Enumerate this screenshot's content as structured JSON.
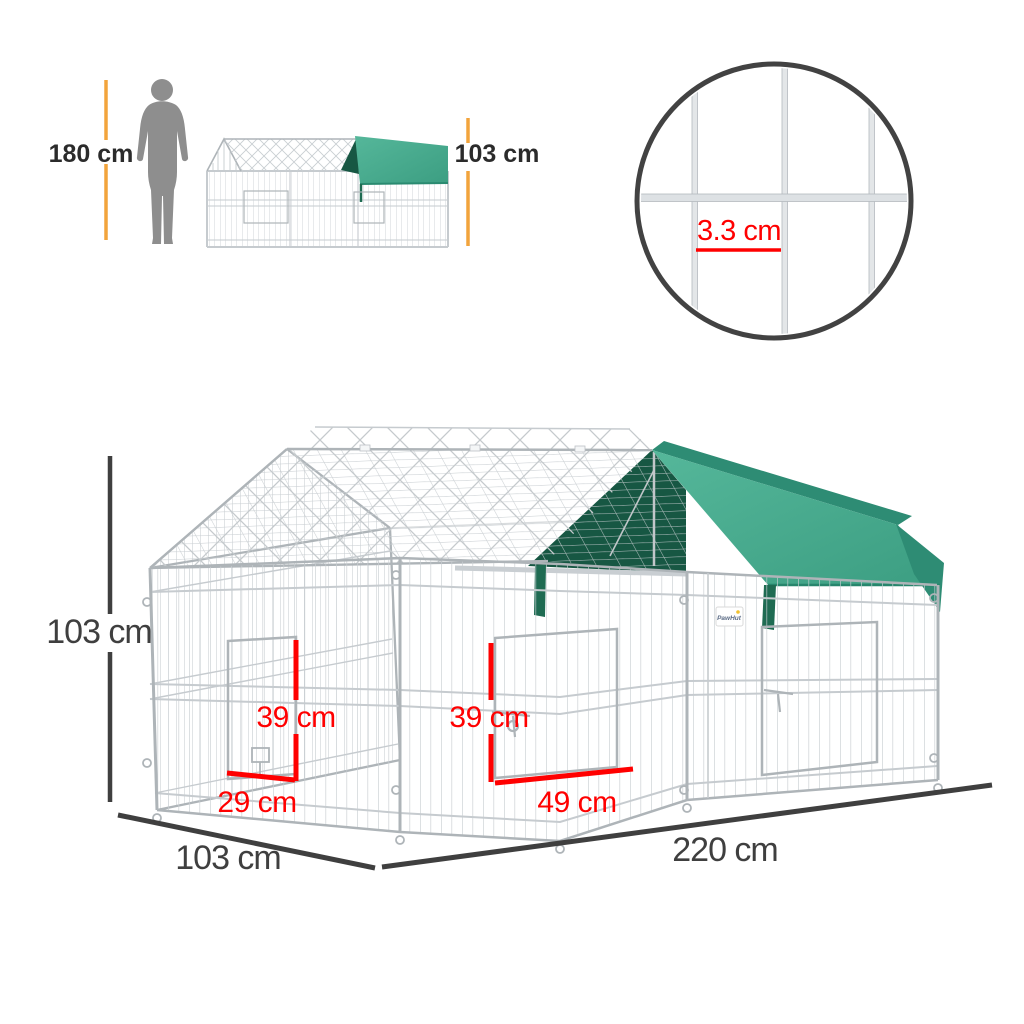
{
  "scale_figures": {
    "person_height": "180 cm",
    "cage_cover_height": "103 cm"
  },
  "mesh_detail": {
    "wire_spacing": "3.3 cm"
  },
  "main_dimensions": {
    "height": "103 cm",
    "depth": "103 cm",
    "length": "220 cm"
  },
  "door_dimensions": {
    "left_door_height": "39 cm",
    "left_door_width": "29 cm",
    "center_door_height": "39 cm",
    "center_door_width": "49 cm"
  },
  "brand": {
    "name": "PawHut"
  },
  "colors": {
    "accent_orange": "#F2A43C",
    "dimension_red": "#FF0000",
    "dimension_dark": "#3F3F3F",
    "label_dark": "#2B2B2B",
    "canopy_green": "#43A78A",
    "canopy_green_dark": "#175743",
    "canopy_green_mid": "#2E8C74",
    "canopy_green_pole": "#1F6B52",
    "wire_gray": "#C6CBCF",
    "wire_dark": "#AEB4B8",
    "silhouette_gray": "#8E8E8E"
  }
}
